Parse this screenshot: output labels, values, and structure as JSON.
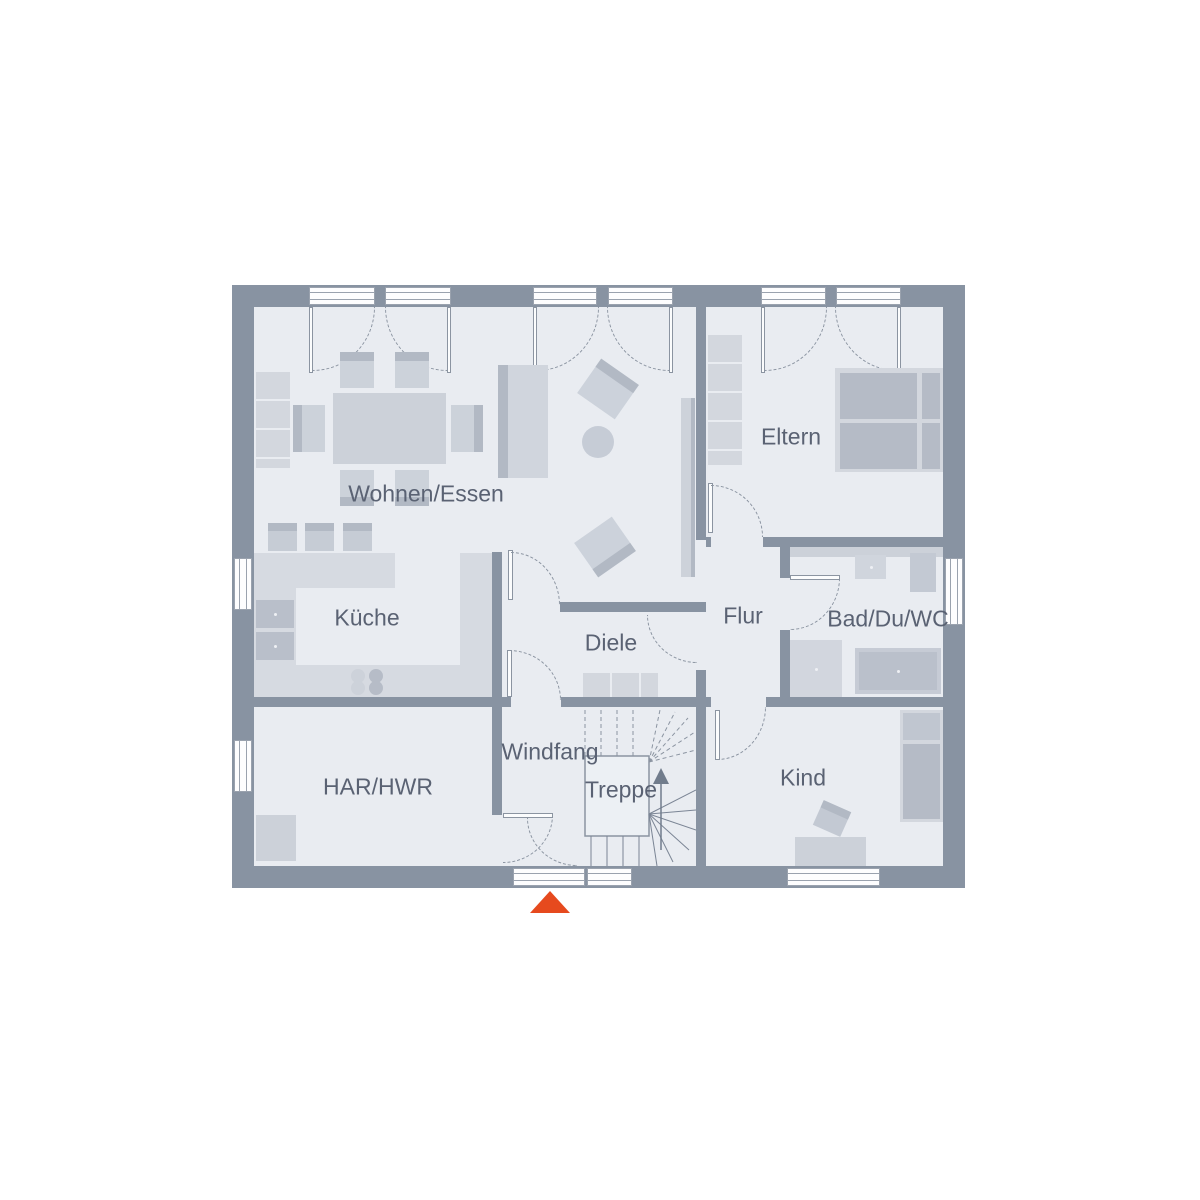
{
  "title": "Erdgeschoss Grundriss",
  "rooms": {
    "wohnen": {
      "label": "Wohnen/Essen"
    },
    "kueche": {
      "label": "Küche"
    },
    "diele": {
      "label": "Diele"
    },
    "flur": {
      "label": "Flur"
    },
    "bad": {
      "label": "Bad/Du/WC"
    },
    "eltern": {
      "label": "Eltern"
    },
    "kind": {
      "label": "Kind"
    },
    "har": {
      "label": "HAR/HWR"
    },
    "windfang": {
      "label": "Windfang"
    },
    "treppe": {
      "label": "Treppe"
    }
  },
  "entrance_marker": {
    "shape": "triangle-up",
    "color": "#e64a1e"
  },
  "palette": {
    "wall": "#8893a2",
    "floor": "#e9ecf1",
    "furniture_light": "#d3d7de",
    "furniture_dark": "#b2b9c4",
    "door_arc": "#8b94a1",
    "label_text": "#5a6273",
    "background": "#ffffff"
  }
}
